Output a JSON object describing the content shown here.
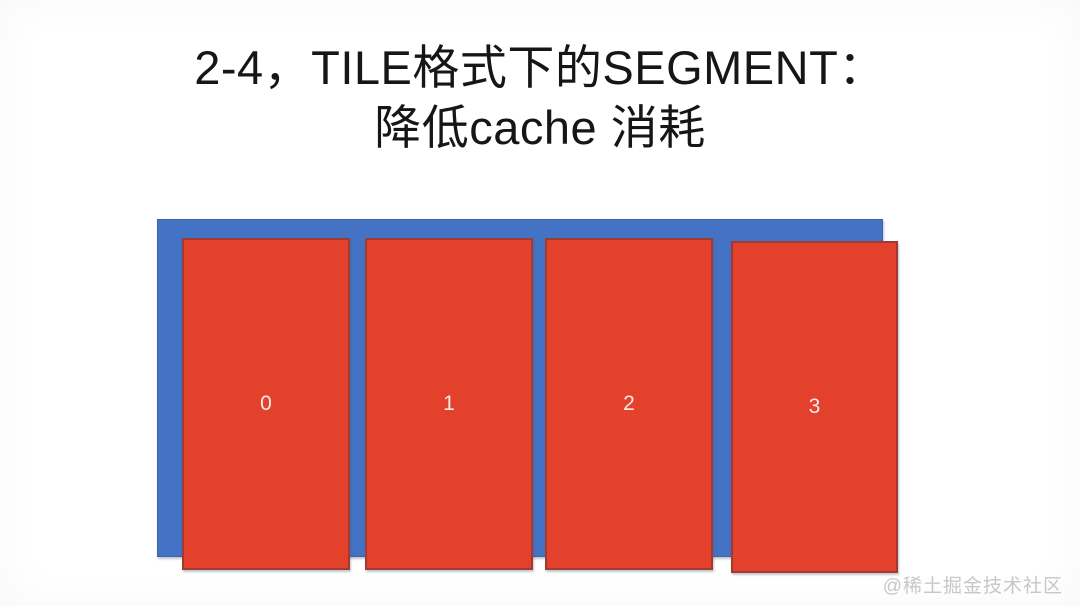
{
  "slide": {
    "title": {
      "line1": "2-4，TILE格式下的SEGMENT：",
      "line2": "降低cache 消耗"
    },
    "diagram": {
      "tiles": [
        {
          "label": "0"
        },
        {
          "label": "1"
        },
        {
          "label": "2"
        },
        {
          "label": "3"
        }
      ]
    },
    "watermark": "@稀土掘金技术社区",
    "colors": {
      "container_blue": "#4472C4",
      "tile_red": "#E4412D",
      "tile_border": "#9E3B33",
      "title_text": "#161616",
      "tile_label_text": "#F5EAE6",
      "watermark_text": "#C7C7C7"
    }
  }
}
